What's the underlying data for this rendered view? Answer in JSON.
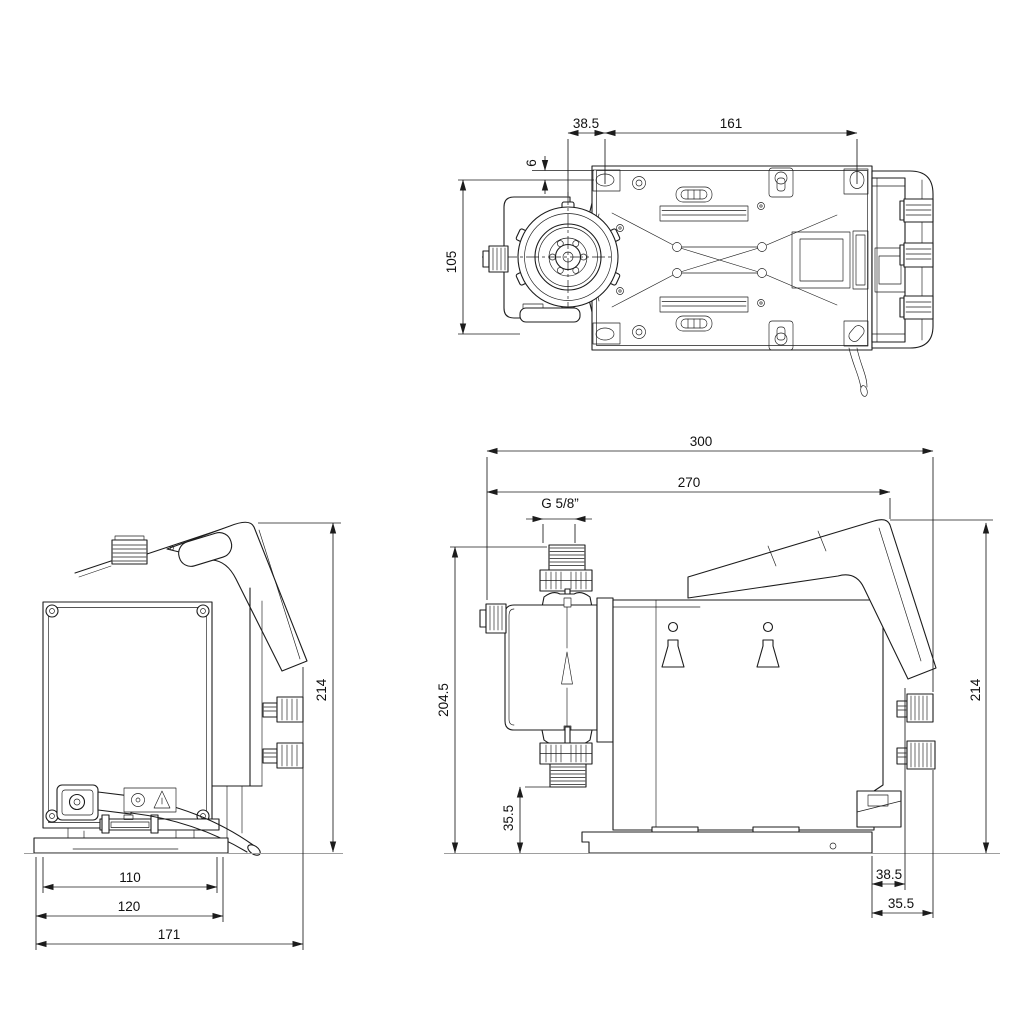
{
  "drawing_type": "pump dimensional drawing (three orthographic views)",
  "colors": {
    "line": "#1c1c1c",
    "ground_line": "#9e9e9e",
    "background": "#ffffff"
  },
  "dims": {
    "top": {
      "offset": "38.5",
      "hole_span": "161",
      "edge_offset": "6",
      "hole_height": "105"
    },
    "rear": {
      "height": "214",
      "inner_width": "110",
      "base_width": "120",
      "depth": "171"
    },
    "side": {
      "total_length": "300",
      "length_to_panel": "270",
      "connection_thread": "G 5/8”",
      "head_height": "204.5",
      "valve_height": "35.5",
      "height": "214",
      "rear_offset_a": "38.5",
      "rear_offset_b": "35.5"
    }
  }
}
